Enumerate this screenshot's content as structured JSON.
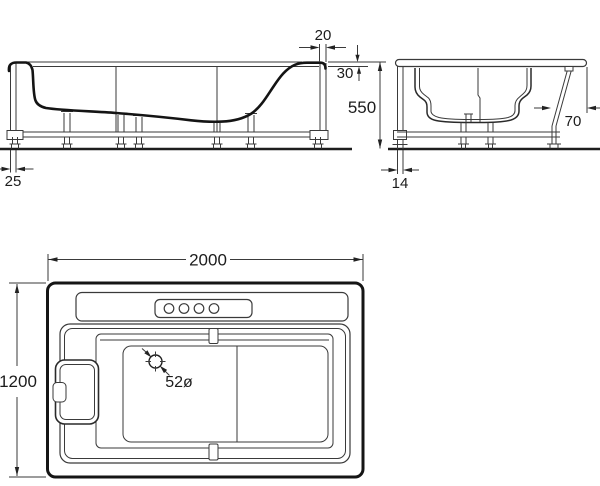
{
  "drawing": {
    "title": "bathtub-installation-dimension-drawing",
    "side_view": {
      "dims": {
        "rim_width": "20",
        "rim_drop": "30",
        "height": "550",
        "base_inset": "25"
      }
    },
    "end_view": {
      "dims": {
        "panel_offset": "70",
        "base_inset": "14"
      }
    },
    "plan_view": {
      "dims": {
        "length": "2000",
        "width": "1200",
        "drain_diameter": "52ø"
      }
    }
  }
}
